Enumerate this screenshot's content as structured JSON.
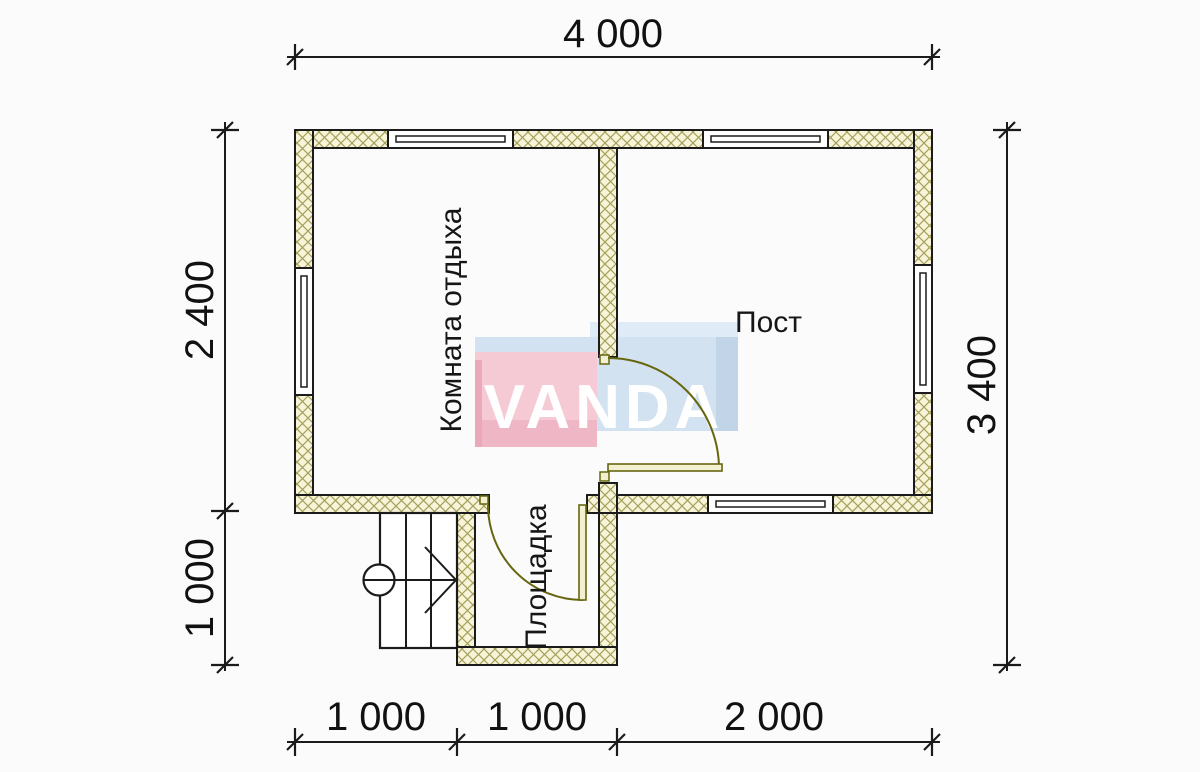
{
  "plan": {
    "watermark": "VANDA",
    "rooms": {
      "rest_room": "Комната отдыха",
      "post": "Пост",
      "landing": "Площадка"
    },
    "dimensions": {
      "top": "4 000",
      "right": "3 400",
      "left_upper": "2 400",
      "left_lower": "1 000",
      "bottom_left": "1 000",
      "bottom_middle": "1 000",
      "bottom_right": "2 000"
    },
    "colors": {
      "wall_fill": "#f7f4da",
      "wall_hatch": "#a3a159",
      "outline": "#1b1b1b",
      "door": "#66660f",
      "logo_pink": "#f5cad4",
      "logo_pink_dark": "#efb6c6",
      "logo_blue": "#d3e2f0",
      "logo_blue_dark": "#c2d4e8",
      "logo_blue_light": "#dfebf6",
      "logo_text": "#ffffff"
    }
  }
}
